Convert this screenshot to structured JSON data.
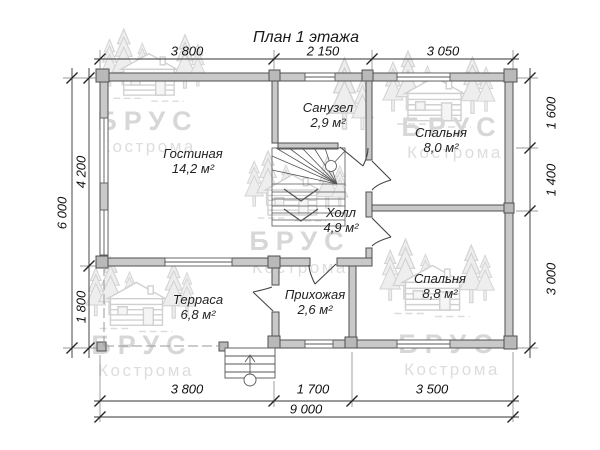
{
  "title": "План 1 этажа",
  "watermark": {
    "brand": "БРУС",
    "city": "Кострома"
  },
  "rooms": {
    "living": {
      "name": "Гостиная",
      "area": "14,2 м²"
    },
    "bathroom": {
      "name": "Санузел",
      "area": "2,9 м²"
    },
    "bedroom_top": {
      "name": "Спальня",
      "area": "8,0 м²"
    },
    "hall": {
      "name": "Холл",
      "area": "4,9 м²"
    },
    "bedroom_bottom": {
      "name": "Спальня",
      "area": "8,8 м²"
    },
    "entry": {
      "name": "Прихожая",
      "area": "2,6 м²"
    },
    "terrace": {
      "name": "Терраса",
      "area": "6,8 м²"
    }
  },
  "dimensions": {
    "top": [
      "3 800",
      "2 150",
      "3 050"
    ],
    "left_total": "6 000",
    "left": [
      "4 200",
      "1 800"
    ],
    "right": [
      "1 600",
      "1 400",
      "3 000"
    ],
    "bottom": [
      "3 800",
      "1 700",
      "3 500"
    ],
    "bottom_total": "9 000"
  }
}
